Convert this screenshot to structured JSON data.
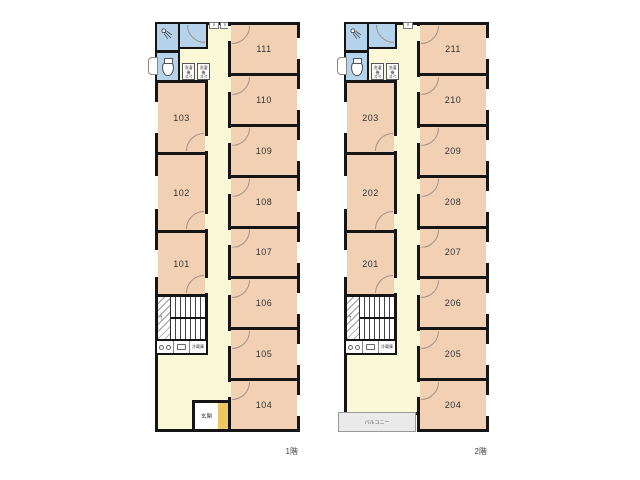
{
  "colors": {
    "wall": "#151515",
    "room_fill": "#f2d0b4",
    "corridor_fill": "#fbf8d7",
    "wet_area_fill": "#b5d3ea",
    "entrance_fill": "#edc660",
    "balcony_fill": "#eaeaea"
  },
  "floors": [
    {
      "label": "1階",
      "rooms_right": [
        "111",
        "110",
        "109",
        "108",
        "107",
        "106",
        "105",
        "104"
      ],
      "rooms_left": [
        "103",
        "102",
        "101"
      ],
      "entrance": "玄関"
    },
    {
      "label": "2階",
      "rooms_right": [
        "211",
        "210",
        "209",
        "208",
        "207",
        "206",
        "205",
        "204"
      ],
      "rooms_left": [
        "203",
        "202",
        "201"
      ],
      "balcony": "バルコニー"
    }
  ],
  "fixtures": {
    "washer_line1": "洗濯機",
    "washer_line2": "スペース",
    "fridge": "冷蔵庫",
    "vent": "∨",
    "stairs_up": "↑"
  }
}
